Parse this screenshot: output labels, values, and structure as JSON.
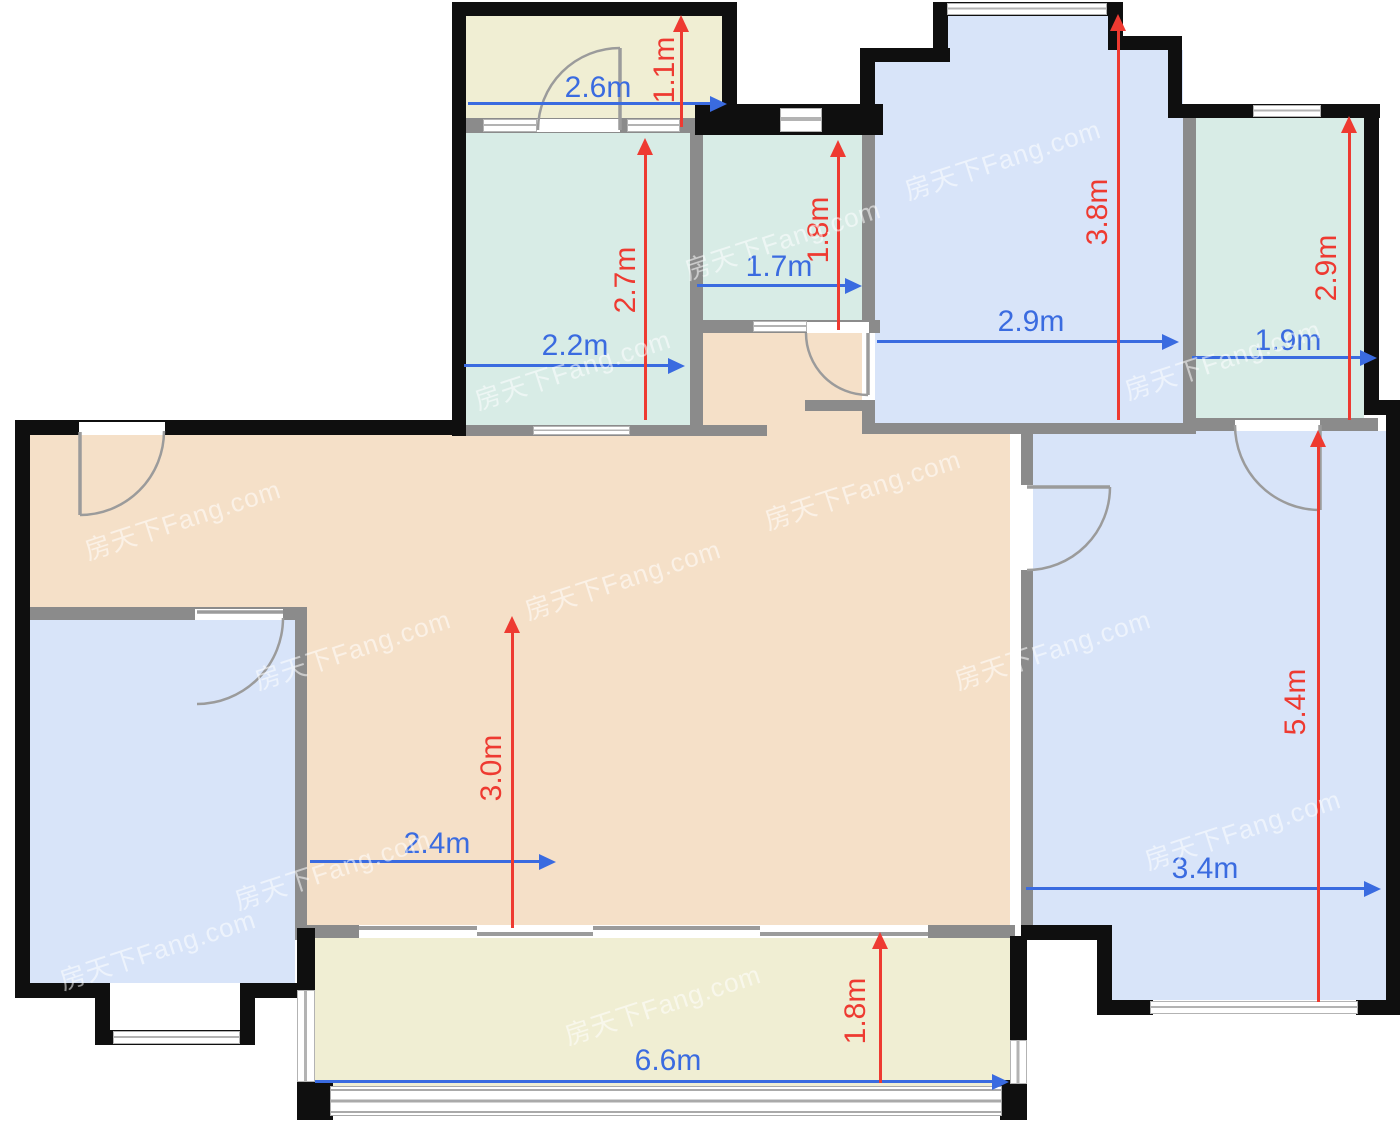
{
  "watermark": {
    "text": "房天下Fang.com"
  },
  "colors": {
    "dim_blue": "#3a6be0",
    "dim_red": "#ee3a31",
    "room_blue": "#d8e4f9",
    "room_teal": "#d8ece6",
    "room_cream": "#f0eed3",
    "room_peach": "#f5e0c8",
    "wall_black": "#0f0f0f",
    "wall_gray": "#8b8b8b"
  },
  "dims": {
    "closet": {
      "w": "2.6m",
      "h": "1.1m"
    },
    "kitchen": {
      "w": "2.2m",
      "h": "2.7m"
    },
    "bath_middle": {
      "w": "1.7m",
      "h": "1.8m"
    },
    "bedroom_top": {
      "w": "2.9m",
      "h": "3.8m"
    },
    "bath_right": {
      "w": "1.9m",
      "h": "2.9m"
    },
    "living": {
      "w": "2.4m",
      "h": "3.0m"
    },
    "bedroom_right": {
      "w": "3.4m",
      "h": "5.4m"
    },
    "balcony": {
      "w": "6.6m",
      "h": "1.8m"
    }
  }
}
